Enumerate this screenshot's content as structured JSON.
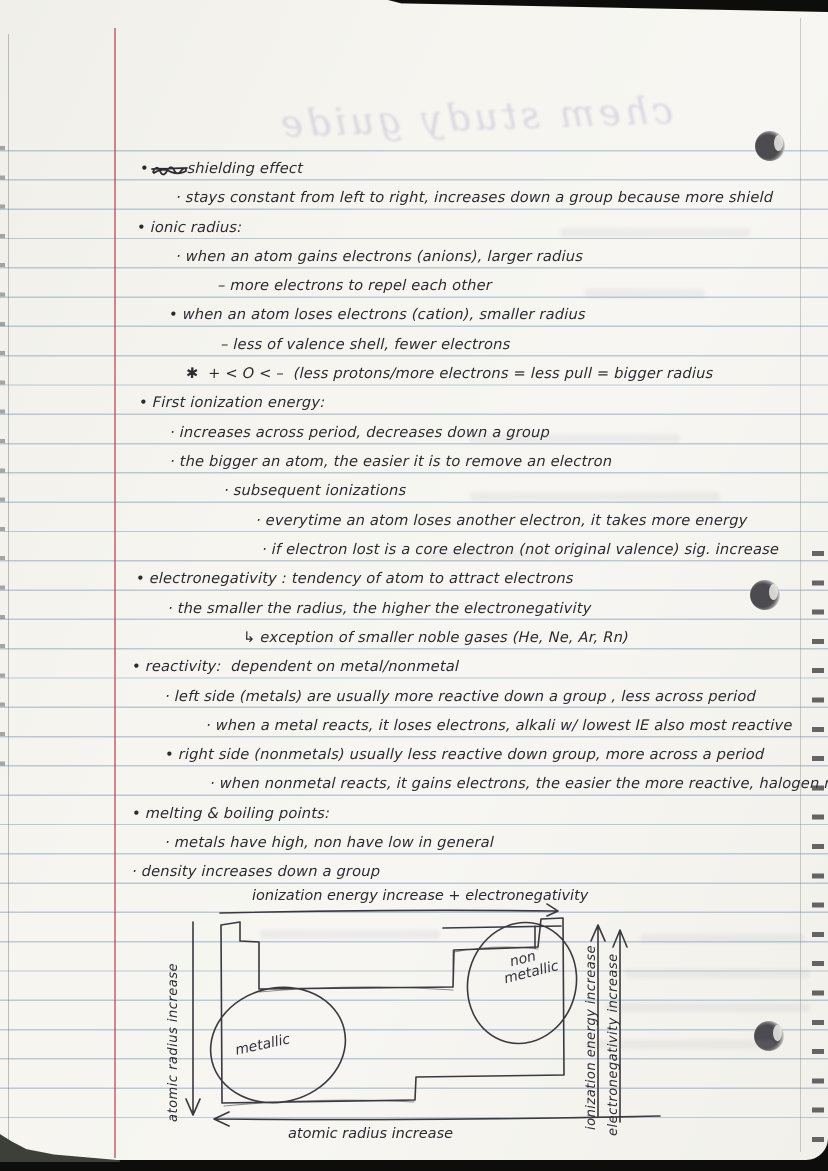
{
  "page": {
    "ghost_title": "chem study guide",
    "colors": {
      "paper": "#f6f5f0",
      "rule_blue": "#6c94ba",
      "margin_red": "#ba4a5c",
      "ink": "#2a2a31"
    }
  },
  "notes": {
    "lines": [
      {
        "text": "•        shielding effect"
      },
      {
        "text": "· stays constant from left to right, increases down a group because more shield"
      },
      {
        "text": "• ionic radius:"
      },
      {
        "text": "· when an atom gains electrons (anions), larger radius"
      },
      {
        "text": "– more electrons to repel each other"
      },
      {
        "text": "• when an atom loses electrons (cation), smaller radius"
      },
      {
        "text": "– less of valence shell, fewer electrons"
      },
      {
        "text": "✱  + < O < –  (less protons/more electrons = less pull = bigger radius"
      },
      {
        "text": "• First ionization energy:"
      },
      {
        "text": "· increases across period, decreases down a group"
      },
      {
        "text": "· the bigger an atom, the easier it is to remove an electron"
      },
      {
        "text": "· subsequent ionizations"
      },
      {
        "text": "· everytime an atom loses another electron, it takes more energy"
      },
      {
        "text": "· if electron lost is a core electron (not original valence) sig. increase"
      },
      {
        "text": "• electronegativity : tendency of atom to attract electrons"
      },
      {
        "text": "· the smaller the radius, the higher the electronegativity"
      },
      {
        "text": "↳ exception of smaller noble gases (He, Ne, Ar, Rn)"
      },
      {
        "text": "• reactivity:  dependent on metal/nonmetal"
      },
      {
        "text": "· left side (metals) are usually more reactive down a group , less across period"
      },
      {
        "text": "· when a metal reacts, it loses electrons, alkali w/ lowest IE also most reactive"
      },
      {
        "text": "• right side (nonmetals) usually less reactive down group, more across a period"
      },
      {
        "text": "· when nonmetal reacts, it gains electrons, the easier the more reactive, halogen n EN"
      },
      {
        "text": "• melting & boiling points:"
      },
      {
        "text": "· metals have high, non have low in general"
      },
      {
        "text": "· density increases down a group"
      }
    ]
  },
  "diagram": {
    "top_label": "ionization energy increase + electronegativity",
    "left_label": "atomic radius increase",
    "bottom_label": "atomic radius increase",
    "right_label_1": "ionization energy increase",
    "right_label_2": "electronegativity increase",
    "region_left": "metallic",
    "region_right_line1": "non",
    "region_right_line2": "metallic"
  }
}
